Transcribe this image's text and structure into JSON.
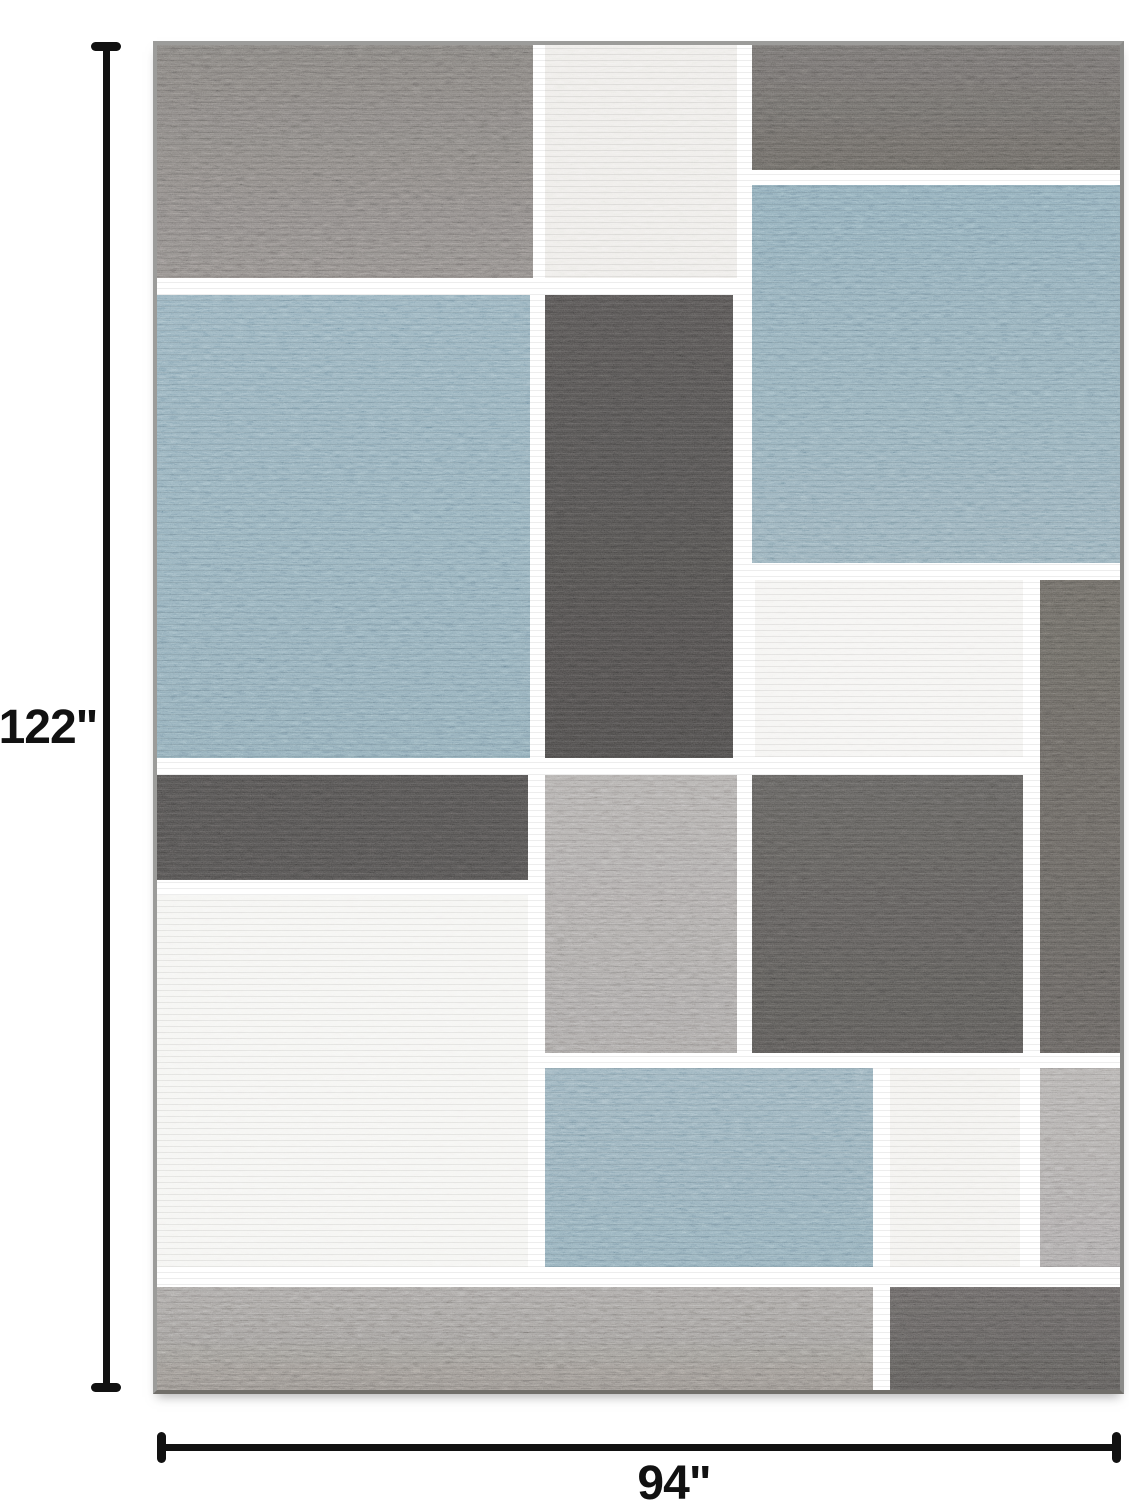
{
  "page": {
    "width": 1129,
    "height": 1500,
    "background": "#ffffff"
  },
  "annotations": {
    "height_label": "122\"",
    "width_label": "94\"",
    "line_color": "#111111"
  },
  "rug": {
    "left": 157,
    "top": 45,
    "width": 963,
    "height": 1345,
    "grid_color": "#0b0b0b",
    "edge_color": "#9c9c9a",
    "palette": {
      "blue": "#7796a6",
      "white": "#f2f1ee",
      "charcoal": "#403e3d",
      "dark_gray": "#54514f",
      "medium_gray": "#989492",
      "warm_gray": "#6c6966",
      "strip_gray": "#8d8986"
    },
    "blocks": [
      {
        "name": "top-left-gray",
        "x": 0,
        "y": 0,
        "w": 376,
        "h": 233,
        "color": "#6c6966",
        "color2": "#767270"
      },
      {
        "name": "top-white",
        "x": 388,
        "y": 0,
        "w": 192,
        "h": 233,
        "color": "#e9e7e3"
      },
      {
        "name": "top-right-gray",
        "x": 595,
        "y": 0,
        "w": 368,
        "h": 125,
        "color": "#5f5c5a",
        "color2": "#56534f"
      },
      {
        "name": "right-blue",
        "x": 595,
        "y": 140,
        "w": 368,
        "h": 378,
        "color": "#7493a4",
        "color2": "#7b98a6"
      },
      {
        "name": "left-blue",
        "x": 0,
        "y": 250,
        "w": 373,
        "h": 463,
        "color": "#7a99a9",
        "color2": "#7593a3"
      },
      {
        "name": "center-charcoal",
        "x": 388,
        "y": 250,
        "w": 188,
        "h": 463,
        "color": "#434140",
        "color2": "#3c3a39"
      },
      {
        "name": "mid-white",
        "x": 598,
        "y": 535,
        "w": 268,
        "h": 177,
        "color": "#f2f1ee"
      },
      {
        "name": "right-column-dark-gray",
        "x": 883,
        "y": 535,
        "w": 80,
        "h": 473,
        "color": "#57544f",
        "color2": "#504d4a"
      },
      {
        "name": "left-dark-strip",
        "x": 0,
        "y": 730,
        "w": 371,
        "h": 105,
        "color": "#413f3e"
      },
      {
        "name": "center-medium-gray",
        "x": 388,
        "y": 730,
        "w": 192,
        "h": 278,
        "color": "#9a9694",
        "color2": "#918d8b"
      },
      {
        "name": "mid-right-dark-gray",
        "x": 595,
        "y": 730,
        "w": 271,
        "h": 278,
        "color": "#4e4c4a",
        "color2": "#474543"
      },
      {
        "name": "left-white",
        "x": 0,
        "y": 850,
        "w": 371,
        "h": 372,
        "color": "#f3f2ef"
      },
      {
        "name": "bottom-blue",
        "x": 388,
        "y": 1023,
        "w": 328,
        "h": 199,
        "color": "#7d9aa9",
        "color2": "#7795a5"
      },
      {
        "name": "bottom-white",
        "x": 733,
        "y": 1023,
        "w": 130,
        "h": 199,
        "color": "#f0eeeb"
      },
      {
        "name": "bottom-right-light-gray",
        "x": 883,
        "y": 1023,
        "w": 80,
        "h": 199,
        "color": "#9d9996",
        "color2": "#949090"
      },
      {
        "name": "bottom-strip-gray",
        "x": 0,
        "y": 1242,
        "w": 716,
        "h": 103,
        "color": "#918d8a",
        "color2": "#7c7874"
      },
      {
        "name": "bottom-strip-dark",
        "x": 733,
        "y": 1242,
        "w": 230,
        "h": 103,
        "color": "#545150",
        "color2": "#4a4846"
      }
    ]
  }
}
